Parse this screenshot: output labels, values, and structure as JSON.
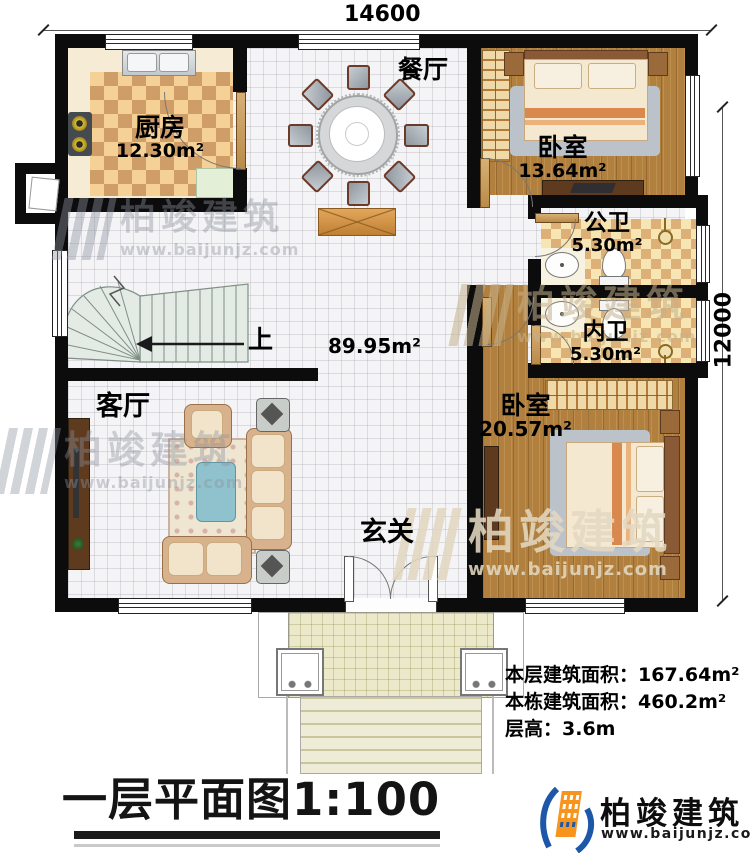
{
  "dimensions": {
    "top": "14600",
    "right": "12000"
  },
  "rooms": {
    "kitchen": {
      "name": "厨房",
      "area": "12.30m²"
    },
    "dining": {
      "name": "餐厅"
    },
    "bedroom1": {
      "name": "卧室",
      "area": "13.64m²"
    },
    "public_bath": {
      "name": "公卫",
      "area": "5.30m²"
    },
    "private_bath": {
      "name": "内卫",
      "area": "5.30m²"
    },
    "bedroom2": {
      "name": "卧室",
      "area": "20.57m²"
    },
    "living": {
      "name": "客厅"
    },
    "foyer": {
      "name": "玄关"
    },
    "hall_area": "89.95m²",
    "stairs_direction": "上"
  },
  "stats": {
    "floor_area_label": "本层建筑面积：",
    "floor_area_value": "167.64m²",
    "building_area_label": "本栋建筑面积：",
    "building_area_value": "460.2m²",
    "floor_height_label": "层高：",
    "floor_height_value": "3.6m"
  },
  "title": "一层平面图1:100",
  "brand": {
    "name": "柏竣建筑",
    "url": "www.baijunjz.com"
  },
  "colors": {
    "wall": "#0c0c0c",
    "brand_blue": "#1d57a8",
    "brand_orange": "#f7941d"
  }
}
